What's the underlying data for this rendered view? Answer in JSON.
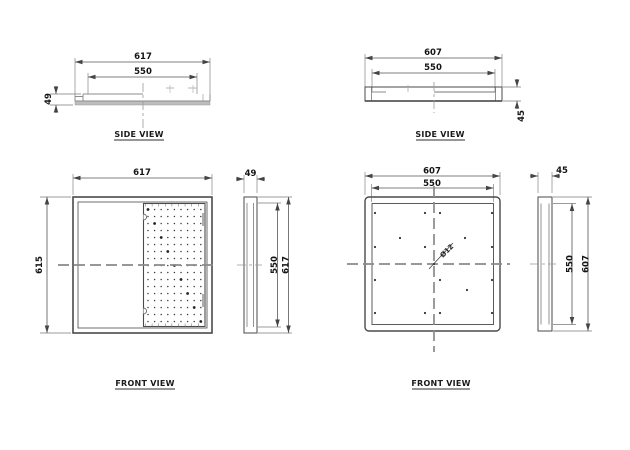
{
  "drawing": {
    "background": "#ffffff",
    "line_color": "#4a4a4a",
    "centerline_color": "#8a8a8a",
    "tray_base_fill": "#bdbdbd"
  },
  "side_view_a": {
    "title": "SIDE VIEW",
    "dim_outer_width": "617",
    "dim_inner_width": "550",
    "dim_height": "49"
  },
  "side_view_b": {
    "title": "SIDE VIEW",
    "dim_outer_width": "607",
    "dim_inner_width": "550",
    "dim_height": "45"
  },
  "front_view_a": {
    "title": "FRONT VIEW",
    "dim_width": "617",
    "dim_height": "615",
    "profile": {
      "dim_width": "49",
      "dim_inner_height": "550",
      "dim_outer_height": "617"
    },
    "perforation": {
      "cols": 9,
      "rows": 17,
      "x0": 148,
      "y0": 209.5,
      "dx": 6.6,
      "dy": 7.0,
      "tick_top_y": 203.5,
      "tick_bottom_y": 323.5,
      "tick_len": 3
    }
  },
  "front_view_b": {
    "title": "FRONT VIEW",
    "dim_outer_width": "607",
    "dim_inner_width": "550",
    "hole_callout": "Ø12",
    "profile": {
      "dim_width": "45",
      "dim_inner_height": "550",
      "dim_outer_height": "607"
    },
    "holes": [
      [
        375,
        213
      ],
      [
        425,
        213
      ],
      [
        440,
        213
      ],
      [
        492,
        213
      ],
      [
        400,
        238
      ],
      [
        465,
        238
      ],
      [
        375,
        247
      ],
      [
        425,
        247
      ],
      [
        492,
        247
      ],
      [
        375,
        280
      ],
      [
        440,
        280
      ],
      [
        492,
        280
      ],
      [
        467,
        290
      ],
      [
        375,
        313
      ],
      [
        425,
        313
      ],
      [
        440,
        313
      ],
      [
        492,
        313
      ],
      [
        434,
        264
      ]
    ]
  }
}
